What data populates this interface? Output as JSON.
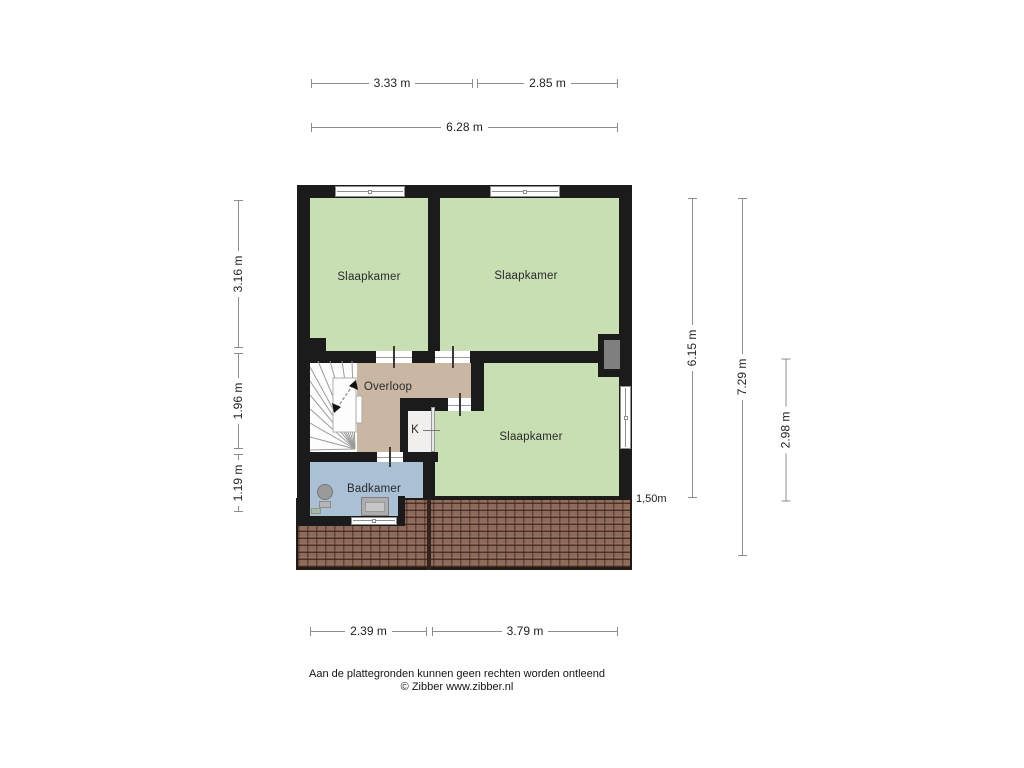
{
  "plan": {
    "rooms": {
      "bedroom_top_left": "Slaapkamer",
      "bedroom_top_right": "Slaapkamer",
      "bedroom_bottom": "Slaapkamer",
      "landing": "Overloop",
      "closet": "K",
      "bathroom": "Badkamer"
    },
    "annotations": {
      "knee_wall_height": "1,50m"
    }
  },
  "dimensions": {
    "top": {
      "left": "3.33 m",
      "right": "2.85 m",
      "total": "6.28 m"
    },
    "left": {
      "upper": "3.16 m",
      "middle": "1.96 m",
      "lower": "1.19 m"
    },
    "right": {
      "inner": "6.15 m",
      "outer": "7.29 m",
      "lower": "2.98 m"
    },
    "bottom": {
      "left": "2.39 m",
      "right": "3.79 m"
    }
  },
  "footer": {
    "disclaimer": "Aan de plattegronden kunnen geen rechten worden ontleend",
    "copyright": "© Zibber www.zibber.nl"
  },
  "colors": {
    "wall": "#1b1b1b",
    "room-green": "#c8dfb3",
    "landing-tan": "#c9b7a3",
    "bathroom-blue": "#a9c0d5",
    "closet-white": "#f0efed",
    "roof-brown": "#8e6a5a",
    "flue-gray": "#7f7f7f",
    "dim-line": "#8c8c8c",
    "dim-text": "#222222",
    "label-text": "#2a2a2a"
  }
}
